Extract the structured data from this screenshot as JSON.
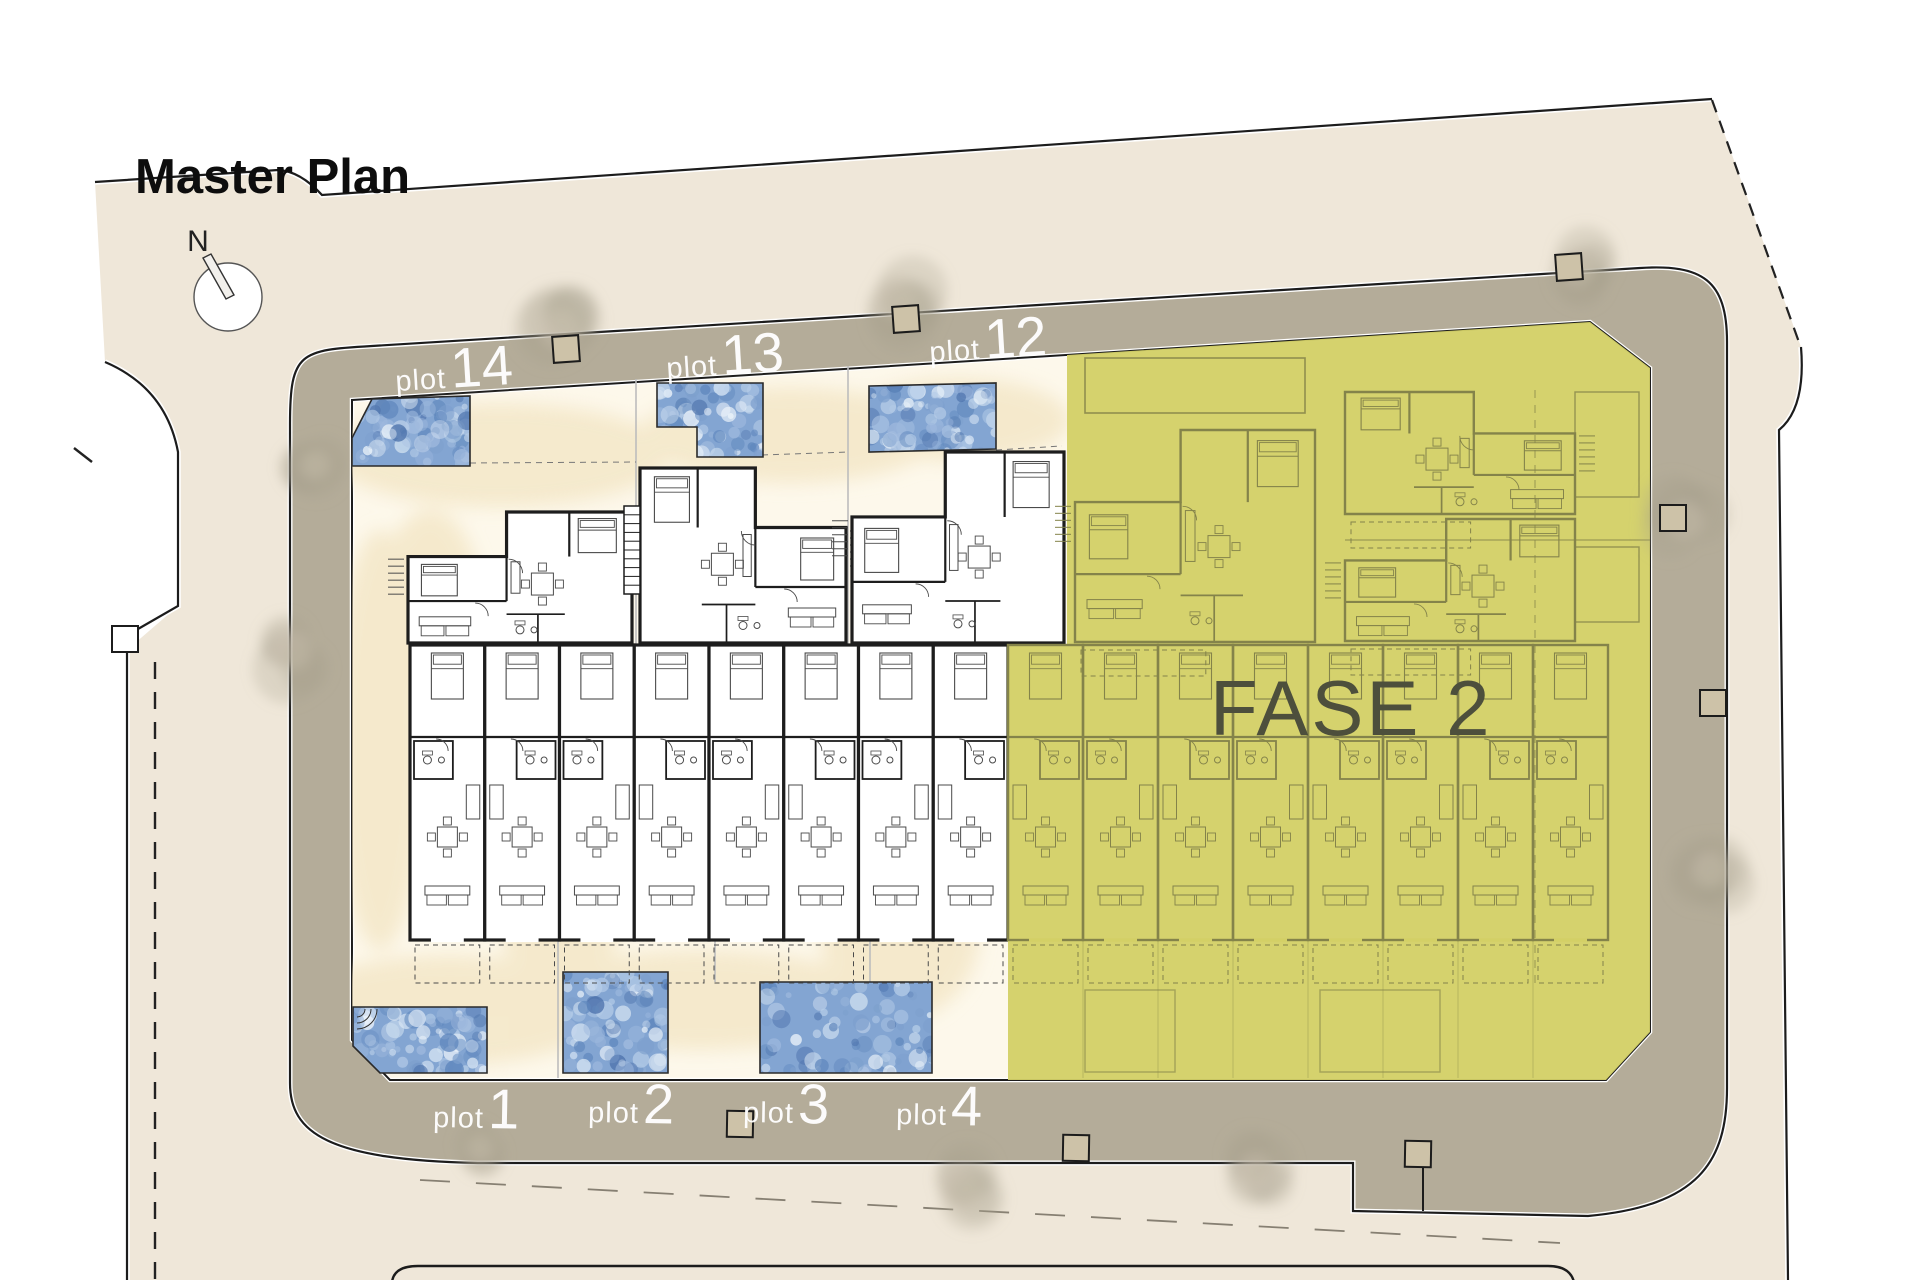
{
  "title": "Master Plan",
  "compass": {
    "label": "N"
  },
  "zones": {
    "fase2_label": "FASE 2"
  },
  "plots": {
    "top": [
      {
        "id": "plot-14",
        "prefix": "plot",
        "number": "14"
      },
      {
        "id": "plot-13",
        "prefix": "plot",
        "number": "13"
      },
      {
        "id": "plot-12",
        "prefix": "plot",
        "number": "12"
      }
    ],
    "bottom": [
      {
        "id": "plot-1",
        "prefix": "plot",
        "number": "1"
      },
      {
        "id": "plot-2",
        "prefix": "plot",
        "number": "2"
      },
      {
        "id": "plot-3",
        "prefix": "plot",
        "number": "3"
      },
      {
        "id": "plot-4",
        "prefix": "plot",
        "number": "4"
      }
    ]
  },
  "colors": {
    "page_bg": "#ffffff",
    "site_beige": "#efe7d9",
    "road_taupe": "#b4ac99",
    "block_cream": "#fdf8eb",
    "courtyard_wash": "#f1e2bd",
    "wall_dark": "#1d1d1d",
    "furniture_gray": "#4a4a4a",
    "pool_base": "#83a5d2",
    "pool_edge": "#2a2a2a",
    "fase2_fill": "#d3d066",
    "fase2_lines": "#84834a",
    "fase2_text": "#4d4f3c",
    "label_white": "#ffffff",
    "title_color": "#0d0d0d",
    "separator_gray": "#bdbdbd",
    "tree_fill": "#a89d8a",
    "outline_dark": "#1c1c1c",
    "box_fill": "#cdc2a8"
  }
}
